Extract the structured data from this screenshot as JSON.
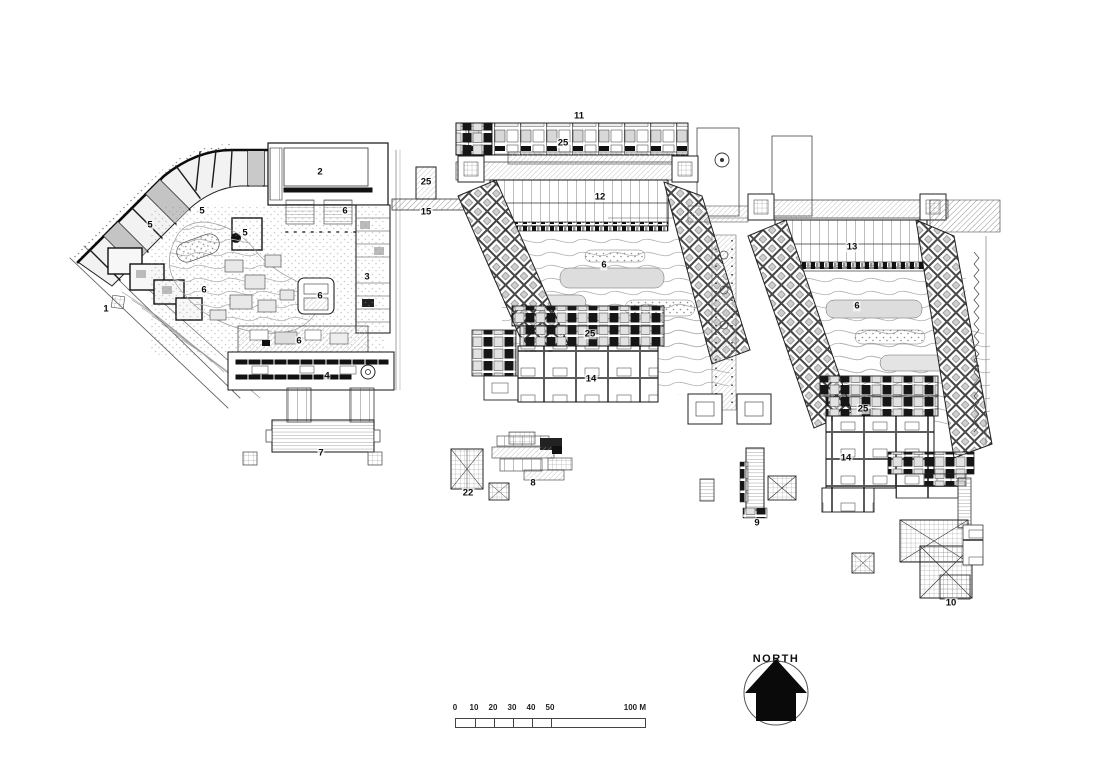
{
  "plan_labels": [
    {
      "text": "1",
      "x": 106,
      "y": 309
    },
    {
      "text": "2",
      "x": 320,
      "y": 172
    },
    {
      "text": "3",
      "x": 367,
      "y": 277
    },
    {
      "text": "4",
      "x": 327,
      "y": 376
    },
    {
      "text": "5",
      "x": 150,
      "y": 225
    },
    {
      "text": "5",
      "x": 202,
      "y": 211
    },
    {
      "text": "5",
      "x": 245,
      "y": 233
    },
    {
      "text": "6",
      "x": 204,
      "y": 290
    },
    {
      "text": "6",
      "x": 345,
      "y": 211
    },
    {
      "text": "6",
      "x": 320,
      "y": 296
    },
    {
      "text": "6",
      "x": 299,
      "y": 341
    },
    {
      "text": "6",
      "x": 604,
      "y": 265
    },
    {
      "text": "6",
      "x": 857,
      "y": 306
    },
    {
      "text": "7",
      "x": 321,
      "y": 453
    },
    {
      "text": "8",
      "x": 533,
      "y": 483
    },
    {
      "text": "9",
      "x": 757,
      "y": 523
    },
    {
      "text": "10",
      "x": 951,
      "y": 603
    },
    {
      "text": "11",
      "x": 579,
      "y": 116
    },
    {
      "text": "12",
      "x": 600,
      "y": 197
    },
    {
      "text": "13",
      "x": 852,
      "y": 247
    },
    {
      "text": "14",
      "x": 591,
      "y": 379
    },
    {
      "text": "14",
      "x": 846,
      "y": 458
    },
    {
      "text": "15",
      "x": 426,
      "y": 212
    },
    {
      "text": "22",
      "x": 468,
      "y": 493
    },
    {
      "text": "25",
      "x": 563,
      "y": 143
    },
    {
      "text": "25",
      "x": 426,
      "y": 182
    },
    {
      "text": "25",
      "x": 590,
      "y": 334
    },
    {
      "text": "25",
      "x": 863,
      "y": 409
    }
  ],
  "north_arrow": {
    "label": "NORTH"
  },
  "scale_bar": {
    "tick_labels": [
      "0",
      "10",
      "20",
      "30",
      "40",
      "50"
    ],
    "end_label": "100 M",
    "tick_spacing_px": 19
  },
  "colors": {
    "ink": "#1a1a1a",
    "light_fill": "#f0f0f0",
    "mid_gray": "#c9c9c9"
  }
}
